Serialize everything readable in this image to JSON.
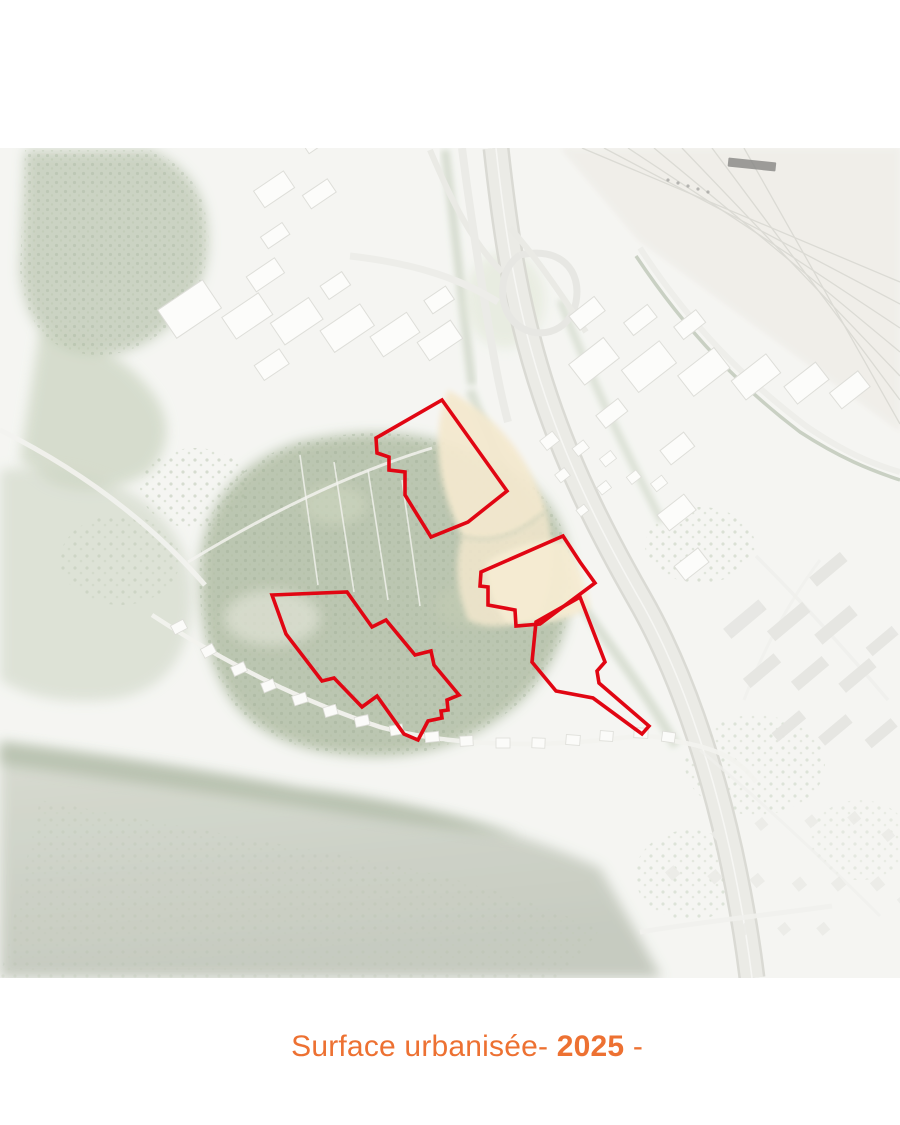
{
  "page": {
    "width": 900,
    "height": 1125,
    "background": "#ffffff"
  },
  "caption": {
    "prefix": "Surface urbanisée- ",
    "year": "2025",
    "suffix": " -",
    "color": "#ED7132"
  },
  "map": {
    "kind": "aerial-orthophoto",
    "description": "Washed-out aerial photo of an urban fringe: forested hill with four red parcel outlines, motorway interchange, railway yard, industrial and residential areas",
    "parcel_color": "#E10613",
    "parcel_stroke_width": 3.6,
    "parcels": [
      {
        "name": "parcel-north",
        "points": [
          [
            442,
            400
          ],
          [
            507,
            491
          ],
          [
            468,
            522
          ],
          [
            431,
            537
          ],
          [
            405,
            495
          ],
          [
            405,
            472
          ],
          [
            389,
            470
          ],
          [
            389,
            457
          ],
          [
            377,
            453
          ],
          [
            376,
            438
          ]
        ]
      },
      {
        "name": "parcel-center",
        "points": [
          [
            563,
            536
          ],
          [
            580,
            562
          ],
          [
            595,
            583
          ],
          [
            540,
            624
          ],
          [
            516,
            626
          ],
          [
            515,
            610
          ],
          [
            488,
            605
          ],
          [
            488,
            587
          ],
          [
            480,
            586
          ],
          [
            481,
            572
          ]
        ]
      },
      {
        "name": "parcel-east",
        "points": [
          [
            580,
            597
          ],
          [
            605,
            662
          ],
          [
            597,
            671
          ],
          [
            599,
            683
          ],
          [
            649,
            726
          ],
          [
            642,
            734
          ],
          [
            593,
            698
          ],
          [
            556,
            691
          ],
          [
            532,
            662
          ],
          [
            536,
            622
          ]
        ]
      },
      {
        "name": "parcel-west",
        "points": [
          [
            272,
            595
          ],
          [
            347,
            592
          ],
          [
            372,
            627
          ],
          [
            386,
            620
          ],
          [
            415,
            655
          ],
          [
            431,
            651
          ],
          [
            434,
            665
          ],
          [
            459,
            695
          ],
          [
            447,
            700
          ],
          [
            448,
            710
          ],
          [
            441,
            711
          ],
          [
            442,
            718
          ],
          [
            428,
            721
          ],
          [
            418,
            740
          ],
          [
            404,
            734
          ],
          [
            377,
            696
          ],
          [
            362,
            707
          ],
          [
            334,
            678
          ],
          [
            322,
            681
          ],
          [
            286,
            634
          ]
        ]
      }
    ],
    "features": [
      "forest",
      "farmland",
      "motorway",
      "interchange",
      "railway-yard",
      "industrial-buildings",
      "village-road",
      "residential-area",
      "canal"
    ]
  }
}
